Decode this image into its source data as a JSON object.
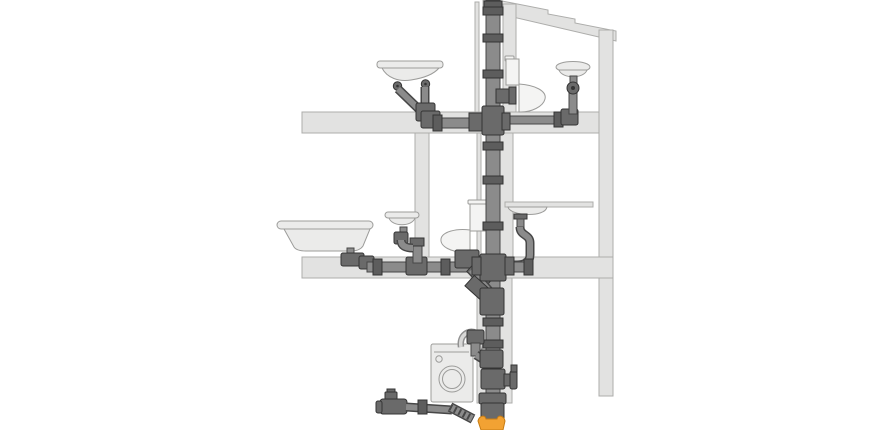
{
  "canvas": {
    "viewBox": "0 0 870 430"
  },
  "colors": {
    "background": "#ffffff",
    "wall": "#e2e2e1",
    "wallStroke": "#adadab",
    "fixture": "#ebebea",
    "fixtureStroke": "#9c9c9a",
    "fixtureLight": "#f4f4f3",
    "pipe": "#8b8b8b",
    "pipeStroke": "#474747",
    "fitting": "#6a6a6a",
    "fittingStroke": "#343434",
    "coupling": "#5d5d5d",
    "hose": "#d8d8d7",
    "hoseDark": "#909090",
    "orange": "#f2a233",
    "orangeStroke": "#c77c14"
  },
  "diagram": {
    "type": "illustration",
    "subject": "two-storey building cross-section showing drainage soil stack and fixture connections",
    "components": [
      "vent-soil-stack",
      "roof",
      "outer-wall",
      "upper-floor-slab",
      "lower-floor-slab",
      "partition-wall",
      "pipe-chase",
      "double-basin-upper",
      "toilet-upper",
      "washbasin-upper",
      "bathtub",
      "pedestal-basin",
      "toilet-lower",
      "kitchen-sink",
      "washing-machine",
      "washing-machine-hose",
      "cleanout-access",
      "floor-drain-branch",
      "corrugated-connector",
      "underground-sewer-connector"
    ]
  }
}
